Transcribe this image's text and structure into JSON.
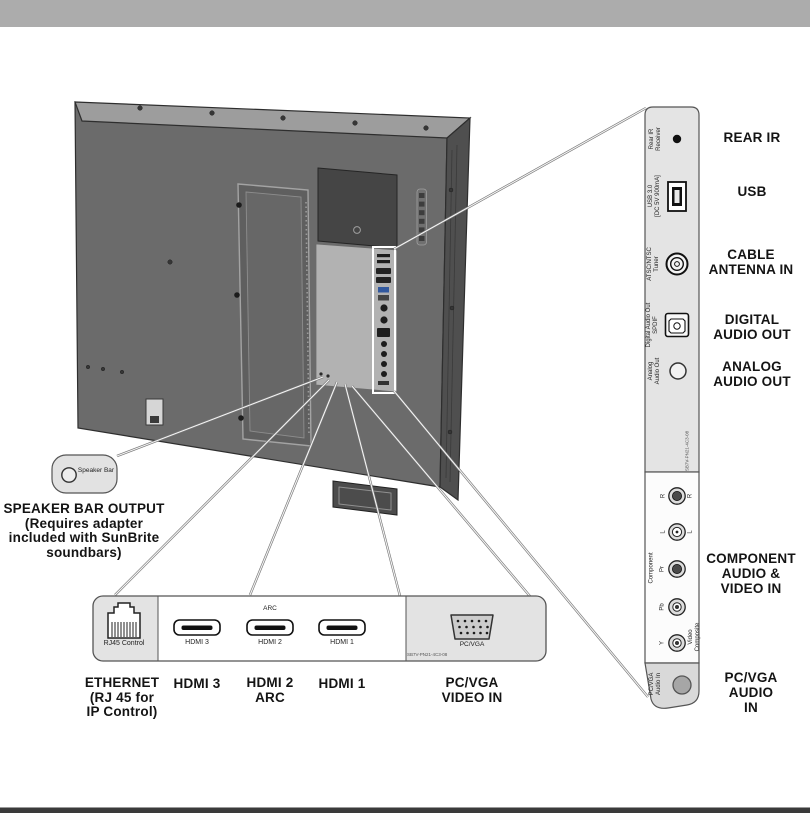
{
  "colors": {
    "top_bar": "#acacac",
    "bottom_bar": "#3a3a3a",
    "panel_gray": "#e4e4e4",
    "panel_white": "#fcfcfc",
    "tv_back": "#6b6b6b",
    "tv_top": "#9d9d9d",
    "tv_side": "#4f4f4f",
    "usb_plug_accent": "#31589e"
  },
  "speaker_callout": {
    "box_label_lines": [
      "Speaker",
      "Bar"
    ],
    "caption_lines": [
      "SPEAKER BAR OUTPUT",
      "(Requires adapter",
      "included with SunBrite",
      "soundbars)"
    ]
  },
  "side_panel": {
    "rear_ir": {
      "label_lines": [
        "Rear IR",
        "Receiver"
      ],
      "caption": "REAR IR"
    },
    "usb": {
      "label_lines": [
        "USB 3.0",
        "[DC 5V 900mA]"
      ],
      "caption": "USB"
    },
    "tuner": {
      "label_lines": [
        "ATSC/NTSC",
        "Tuner"
      ],
      "caption_lines": [
        "CABLE",
        "ANTENNA IN"
      ]
    },
    "spdif": {
      "label_lines": [
        "Digital Audio Out",
        "SPDIF"
      ],
      "caption_lines": [
        "DIGITAL",
        "AUDIO OUT"
      ]
    },
    "analog": {
      "label_lines": [
        "Analog",
        "Audio Out"
      ],
      "caption_lines": [
        "ANALOG",
        "AUDIO OUT"
      ]
    },
    "small_print": "SB7V-PN21-4C3-08",
    "component": {
      "group_label": "Component",
      "composite_label_lines": [
        "Video",
        "Composite"
      ],
      "jacks": [
        "R",
        "L",
        "Pr",
        "Pb",
        "Y"
      ],
      "caption_lines": [
        "COMPONENT",
        "AUDIO &",
        "VIDEO IN"
      ]
    },
    "pc_audio": {
      "label_lines": [
        "PC/VGA",
        "Audio In"
      ],
      "caption_lines": [
        "PC/VGA",
        "AUDIO",
        "IN"
      ]
    }
  },
  "bottom_panel": {
    "ethernet": {
      "label_lines": [
        "RJ45",
        "Control"
      ],
      "caption_lines": [
        "ETHERNET",
        "(RJ 45 for",
        "IP Control)"
      ]
    },
    "hdmi3": {
      "label": "HDMI 3",
      "caption": "HDMI 3"
    },
    "hdmi2": {
      "label": "HDMI 2",
      "arc_label": "ARC",
      "caption_lines": [
        "HDMI 2",
        "ARC"
      ]
    },
    "hdmi1": {
      "label": "HDMI 1",
      "caption": "HDMI 1"
    },
    "vga": {
      "label": "PC/VGA",
      "caption_lines": [
        "PC/VGA",
        "VIDEO IN"
      ],
      "small_print": "SB7V-PN21-4C3-08"
    }
  }
}
